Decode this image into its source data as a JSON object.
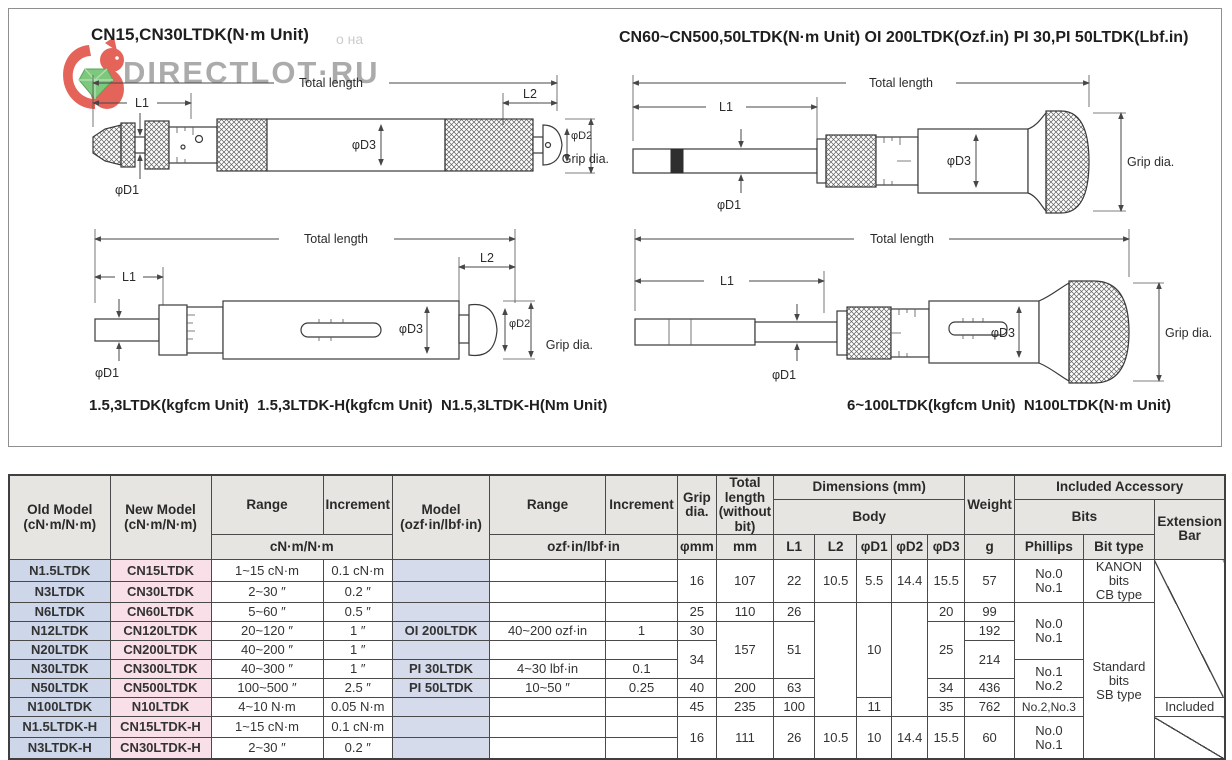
{
  "watermark": {
    "site": "DIRECTLOT·RU",
    "fragment": "о на"
  },
  "figure": {
    "title_left": "CN15,CN30LTDK(N·m Unit)",
    "title_right": "CN60~CN500,50LTDK(N·m Unit) OI 200LTDK(Ozf.in) PI 30,PI 50LTDK(Lbf.in)",
    "caption_left": "1.5,3LTDK(kgfcm Unit)  1.5,3LTDK-H(kgfcm Unit)  N1.5,3LTDK-H(Nm Unit)",
    "caption_right": "6~100LTDK(kgfcm Unit)  N100LTDK(N·m Unit)"
  },
  "diagrams": {
    "total_length": "Total length",
    "l1": "L1",
    "l2": "L2",
    "d1": "φD1",
    "d2": "φD2",
    "d3": "φD3",
    "grip_dia": "Grip dia."
  },
  "table": {
    "head": {
      "old": "Old Model\n(cN·m/N·m)",
      "new": "New Model\n(cN·m/N·m)",
      "range": "Range",
      "increment": "Increment",
      "unit_cnm": "cN·m/N·m",
      "model": "Model\n(ozf·in/lbf·in)",
      "unit_ozf": "ozf·in/lbf·in",
      "grip": "Grip\ndia.",
      "grip_unit": "φmm",
      "total": "Total length\n(without bit)",
      "total_unit": "mm",
      "dims": "Dimensions (mm)",
      "body": "Body",
      "l1": "L1",
      "l2": "L2",
      "d1": "φD1",
      "d2": "φD2",
      "d3": "φD3",
      "weight": "Weight",
      "weight_unit": "g",
      "acc": "Included Accessory",
      "bits": "Bits",
      "phillips": "Phillips",
      "bittype": "Bit type",
      "extbar": "Extension\nBar"
    },
    "rows": [
      {
        "old": "N1.5LTDK",
        "new": "CN15LTDK",
        "range": "1~15 cN·m",
        "inc": "0.1 cN·m",
        "model": "",
        "range2": "",
        "inc2": ""
      },
      {
        "old": "N3LTDK",
        "new": "CN30LTDK",
        "range": "2~30  ″",
        "inc": "0.2  ″",
        "model": "",
        "range2": "",
        "inc2": ""
      },
      {
        "old": "N6LTDK",
        "new": "CN60LTDK",
        "range": "5~60  ″",
        "inc": "0.5  ″",
        "model": "",
        "range2": "",
        "inc2": ""
      },
      {
        "old": "N12LTDK",
        "new": "CN120LTDK",
        "range": "20~120  ″",
        "inc": "1  ″",
        "model": "OI 200LTDK",
        "range2": "40~200 ozf·in",
        "inc2": "1"
      },
      {
        "old": "N20LTDK",
        "new": "CN200LTDK",
        "range": "40~200  ″",
        "inc": "1  ″",
        "model": "",
        "range2": "",
        "inc2": ""
      },
      {
        "old": "N30LTDK",
        "new": "CN300LTDK",
        "range": "40~300  ″",
        "inc": "1  ″",
        "model": "PI 30LTDK",
        "range2": "4~30 lbf·in",
        "inc2": "0.1"
      },
      {
        "old": "N50LTDK",
        "new": "CN500LTDK",
        "range": "100~500  ″",
        "inc": "2.5  ″",
        "model": "PI 50LTDK",
        "range2": "10~50  ″",
        "inc2": "0.25"
      },
      {
        "old": "N100LTDK",
        "new": "N10LTDK",
        "range": "4~10 N·m",
        "inc": "0.05 N·m",
        "model": "",
        "range2": "",
        "inc2": ""
      },
      {
        "old": "N1.5LTDK-H",
        "new": "CN15LTDK-H",
        "range": "1~15 cN·m",
        "inc": "0.1 cN·m",
        "model": "",
        "range2": "",
        "inc2": ""
      },
      {
        "old": "N3LTDK-H",
        "new": "CN30LTDK-H",
        "range": "2~30  ″",
        "inc": "0.2  ″",
        "model": "",
        "range2": "",
        "inc2": ""
      }
    ],
    "merged": {
      "grip": [
        "16",
        "25",
        "30",
        "34",
        "40",
        "45",
        "16"
      ],
      "total": [
        "107",
        "110",
        "157",
        "200",
        "235",
        "111"
      ],
      "l1": [
        "22",
        "26",
        "51",
        "63",
        "100",
        "26"
      ],
      "l2": [
        "10.5",
        "10.5"
      ],
      "d1": [
        "5.5",
        "10",
        "11",
        "10"
      ],
      "d2": [
        "14.4",
        "14.4"
      ],
      "d3": [
        "15.5",
        "20",
        "25",
        "34",
        "35",
        "15.5"
      ],
      "weight": [
        "57",
        "99",
        "192",
        "214",
        "436",
        "762",
        "60"
      ],
      "phillips": [
        "No.0\nNo.1",
        "No.0\nNo.1",
        "No.1\nNo.2",
        "No.2,No.3",
        "No.0\nNo.1"
      ],
      "bittype": [
        "KANON bits\nCB type",
        "Standard bits\nSB type"
      ],
      "extbar_included": "Included"
    }
  },
  "colors": {
    "old_model_col": "#cdd7e9",
    "new_model_col": "#f9dfe8",
    "model_col": "#d6dbec",
    "header_gray": "#e6e5e2",
    "watermark_gray": "#979797",
    "squirrel_red": "#e2574c",
    "gem_green": "#72c472"
  }
}
